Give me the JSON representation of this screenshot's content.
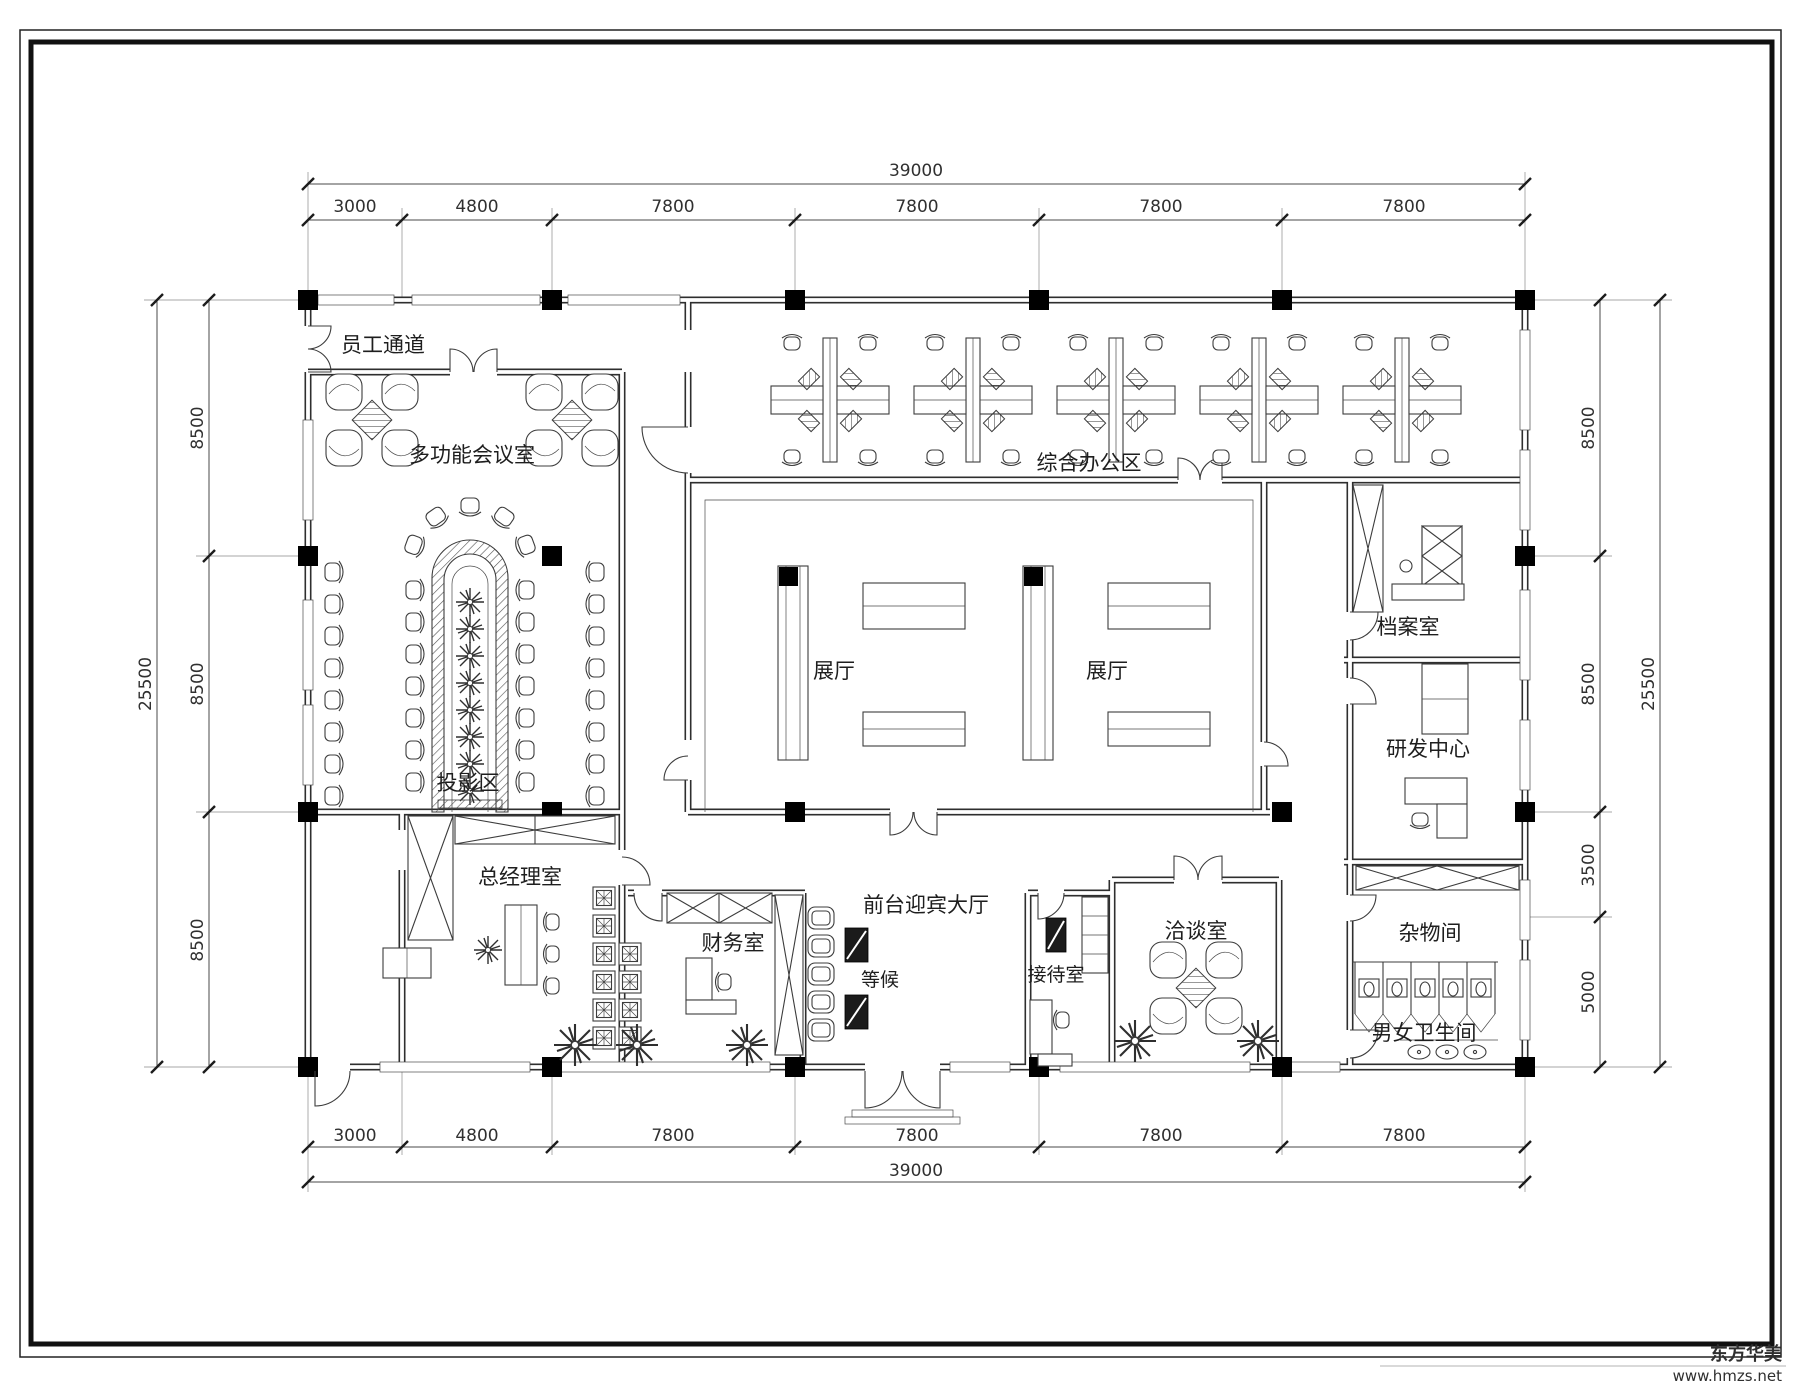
{
  "dimensions": {
    "top": {
      "total": "39000",
      "segments": [
        "3000",
        "4800",
        "7800",
        "7800",
        "7800",
        "7800"
      ]
    },
    "bottom": {
      "total": "39000",
      "segments": [
        "3000",
        "4800",
        "7800",
        "7800",
        "7800",
        "7800"
      ]
    },
    "left": {
      "total": "25500",
      "segments": [
        "8500",
        "8500",
        "8500"
      ]
    },
    "right": {
      "total": "25500",
      "segments": [
        "8500",
        "8500",
        "3500",
        "5000"
      ]
    }
  },
  "rooms": {
    "staff_corridor": "员工通道",
    "multifunction_meeting_room": "多功能会议室",
    "general_office_area": "综合办公区",
    "exhibition_hall_left": "展厅",
    "exhibition_hall_right": "展厅",
    "archive_room": "档案室",
    "rnd_center": "研发中心",
    "projection_area": "投影区",
    "general_manager_office": "总经理室",
    "finance_room": "财务室",
    "waiting_area": "等候",
    "reception_hall": "前台迎宾大厅",
    "reception_room": "接待室",
    "negotiation_room": "洽谈室",
    "storage_room": "杂物间",
    "restrooms": "男女卫生间"
  },
  "watermark": {
    "brand": "东方华美",
    "website": "www.hmzs.net"
  },
  "colors": {
    "line": "#2e2e2e",
    "column": "#000000",
    "background": "#ffffff"
  }
}
